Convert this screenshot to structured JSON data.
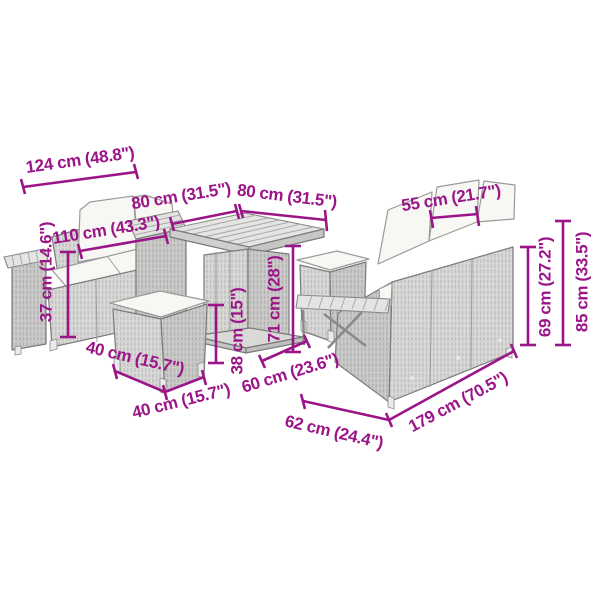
{
  "colors": {
    "accent": "#9b1588",
    "wicker_light": "#d9d9d8",
    "wicker_dark": "#cccccb",
    "slat": "#e4e4e2",
    "cushion": "#f7f7f4",
    "outline": "#7a7a7a",
    "background": "#ffffff"
  },
  "scene": {
    "description": "garden-furniture-set-dimension-diagram",
    "items": [
      "two-seater-sofa",
      "square-table",
      "front-stool",
      "back-stool",
      "three-seater-sofa",
      "armrest-shelf"
    ]
  },
  "dims": {
    "d124": "124 cm (48.8\")",
    "d110": "110 cm (43.3\")",
    "d37": "37 cm (14.6\")",
    "d80_left": "80 cm (31.5\")",
    "d80_right": "80 cm (31.5\")",
    "d55": "55 cm (21.7\")",
    "d71": "71 cm (28\")",
    "d38": "38 cm (15\")",
    "d40_left": "40 cm (15.7\")",
    "d40_right": "40 cm (15.7\")",
    "d60": "60 cm (23.6\")",
    "d62": "62 cm (24.4\")",
    "d179": "179 cm (70.5\")",
    "d69": "69 cm (27.2\")",
    "d85": "85 cm (33.5\")"
  }
}
